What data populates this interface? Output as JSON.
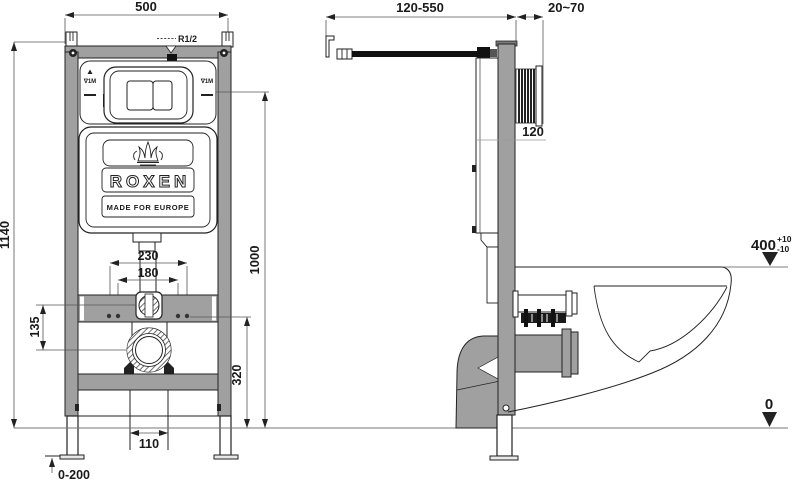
{
  "drawing_type": "wall-hung toilet installation frame, front and side technical views",
  "colors": {
    "frame_gray": "#a0a0a0",
    "line_dark": "#222222",
    "floor_line": "#777777"
  },
  "front": {
    "dim_width": "500",
    "dim_height": "1140",
    "dim_bolt_outer": "230",
    "dim_bolt_inner": "180",
    "dim_elbow_to_drain": "135",
    "dim_holes_to_floor": "320",
    "dim_plate_to_floor": "1000",
    "dim_drain_offset": "110",
    "dim_leg_adjust": "0-200",
    "label_inlet": "R1/2",
    "label_level_left": "∇1M",
    "label_level_right": "∇1M",
    "brand": "ROXEN",
    "tagline": "MADE FOR EUROPE"
  },
  "side": {
    "dim_supply_length": "120-550",
    "dim_wall_offset": "20~70",
    "dim_depth": "120",
    "dim_bowl_height": "400",
    "tol_plus": "+10",
    "tol_minus": "-10",
    "floor_level": "0"
  }
}
